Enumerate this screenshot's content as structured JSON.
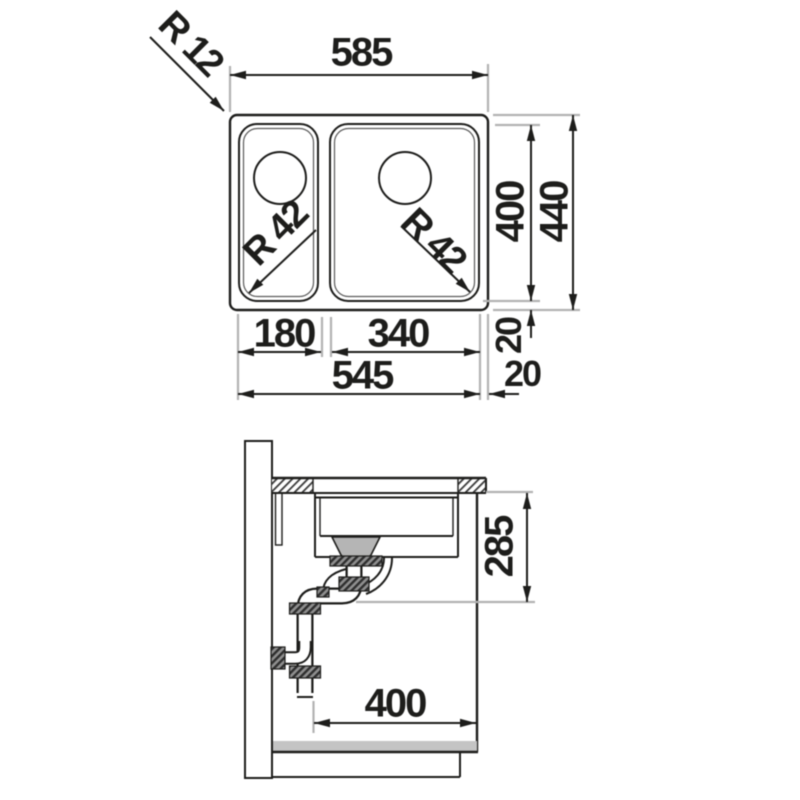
{
  "dims": {
    "top": {
      "overall_width": "585",
      "outer_radius": "R 12",
      "left_bowl_radius": "R 42",
      "right_bowl_radius": "R 42",
      "bowl_depth": "400",
      "overall_depth": "440",
      "rear_rim": "20",
      "left_bowl_width": "180",
      "right_bowl_width": "340",
      "inner_width": "545",
      "side_rim": "20"
    },
    "section": {
      "under_counter_height": "285",
      "cabinet_depth": "400"
    }
  },
  "colors": {
    "line": "#1d1d1b",
    "extension": "#b2b2b2",
    "hatch": "#3a3a3a",
    "gray_fill": "#b5b5b5",
    "shadow": "#c4c4c4",
    "background": "#ffffff"
  }
}
